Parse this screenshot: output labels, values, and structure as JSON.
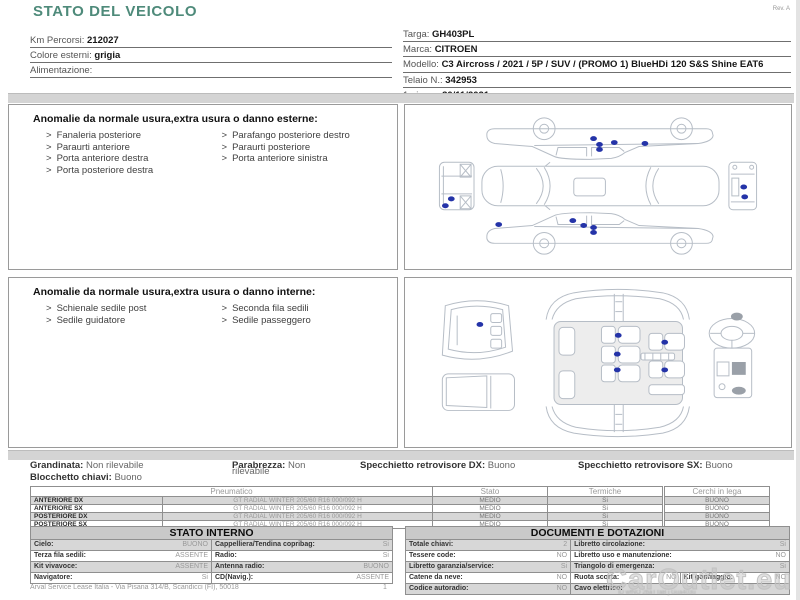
{
  "page": {
    "title": "STATO DEL VEICOLO",
    "rev": "Rev. A",
    "footer": {
      "company": "Arval Service Lease Italia - Via Pisana 314/B, Scandicci (FI), 50018",
      "page_number": "1",
      "watermark": "CarOutlet.eu",
      "id_text": "ID wfNO 2baTTaB j Gua403u"
    }
  },
  "vehicle": {
    "left_fields": [
      {
        "label": "Km Percorsi:",
        "value": "212027"
      },
      {
        "label": "Colore esterni:",
        "value": "grigia"
      },
      {
        "label": "Alimentazione:",
        "value": ""
      }
    ],
    "right_fields": [
      {
        "label": "Targa:",
        "value": "GH403PL"
      },
      {
        "label": "Marca:",
        "value": "CITROEN"
      },
      {
        "label": "Modello:",
        "value": "C3 Aircross / 2021 / 5P / SUV / (PROMO 1) BlueHDi 120 S&S Shine EAT6"
      },
      {
        "label": "Telaio N.:",
        "value": "342953"
      },
      {
        "label": "1a imm.:",
        "value": "30/11/2021"
      }
    ]
  },
  "external_anomalies": {
    "title": "Anomalie da normale usura,extra usura o danno esterne:",
    "bullet": ">",
    "col1": [
      "Fanaleria posteriore",
      "Paraurti anteriore",
      "Porta anteriore destra",
      "Porta posteriore destra"
    ],
    "col2": [
      "Parafango posteriore destro",
      "Paraurti posteriore",
      "Porta anteriore sinistra"
    ]
  },
  "internal_anomalies": {
    "title": "Anomalie da normale usura,extra usura o danno interne:",
    "bullet": ">",
    "col1": [
      "Schienale sedile post",
      "Sedile guidatore"
    ],
    "col2": [
      "Seconda fila sedili",
      "Sedile passeggero"
    ]
  },
  "conditions": {
    "grandinata": {
      "label": "Grandinata:",
      "value": "Non rilevabile"
    },
    "parabrezza": {
      "label": "Parabrezza:",
      "value": "Non",
      "value_overflow": "rilevabile"
    },
    "specchietto_dx": {
      "label": "Specchietto retrovisore DX:",
      "value": "Buono"
    },
    "specchietto_sx": {
      "label": "Specchietto retrovisore SX:",
      "value": "Buono"
    },
    "blocchetto": {
      "label": "Blocchetto chiavi:",
      "value": "Buono"
    }
  },
  "tyres": {
    "header": "Pneumatico",
    "col_stato": "Stato",
    "col_termiche": "Termiche",
    "col_cerchi": "Cerchi in lega",
    "rows": [
      {
        "pos": "ANTERIORE DX",
        "spec": "GT RADIAL WINTER 205/60 R16 000/092 H",
        "stato": "MEDIO",
        "termiche": "Si",
        "cerchi": "BUONO"
      },
      {
        "pos": "ANTERIORE SX",
        "spec": "GT RADIAL WINTER 205/60 R16 000/092 H",
        "stato": "MEDIO",
        "termiche": "Si",
        "cerchi": "BUONO"
      },
      {
        "pos": "POSTERIORE DX",
        "spec": "GT RADIAL WINTER 205/60 R16 000/092 H",
        "stato": "MEDIO",
        "termiche": "Si",
        "cerchi": "BUONO"
      },
      {
        "pos": "POSTERIORE SX",
        "spec": "GT RADIAL WINTER 205/60 R16 000/092 H",
        "stato": "MEDIO",
        "termiche": "Si",
        "cerchi": "BUONO"
      }
    ]
  },
  "stato_interno": {
    "title": "STATO INTERNO",
    "rows": [
      {
        "l_label": "Cielo:",
        "l_value": "BUONO",
        "r_label": "Cappelliera/Tendina copribag:",
        "r_value": "Si"
      },
      {
        "l_label": "Terza fila sedili:",
        "l_value": "ASSENTE",
        "r_label": "Radio:",
        "r_value": "Si"
      },
      {
        "l_label": "Kit vivavoce:",
        "l_value": "ASSENTE",
        "r_label": "Antenna radio:",
        "r_value": "BUONO"
      },
      {
        "l_label": "Navigatore:",
        "l_value": "Si",
        "r_label": "CD(Navig.):",
        "r_value": "ASSENTE"
      }
    ]
  },
  "documenti": {
    "title": "DOCUMENTI E DOTAZIONI",
    "rows_left": [
      {
        "label": "Totale chiavi:",
        "value": "2"
      },
      {
        "label": "Tessere code:",
        "value": "NO"
      },
      {
        "label": "Libretto garanzia/service:",
        "value": "Si"
      },
      {
        "label": "Catene da neve:",
        "value": "NO"
      },
      {
        "label": "Codice autoradio:",
        "value": "NO"
      }
    ],
    "rows_right": [
      {
        "label": "Libretto circolazione:",
        "value": "Si"
      },
      {
        "label": "Libretto uso e manutenzione:",
        "value": "NO"
      },
      {
        "label": "Triangolo di emergenza:",
        "value": "Si"
      },
      {
        "label": "Ruota scorta:",
        "value": "NO",
        "label2": "Kit gonfiaggio:",
        "value2": "NO"
      },
      {
        "label": "Cavo elettrico:",
        "value": ""
      }
    ]
  },
  "diagram_dots": {
    "color": "#2433a8",
    "exterior": [
      [
        190,
        34
      ],
      [
        196,
        40
      ],
      [
        211,
        38
      ],
      [
        242,
        39
      ],
      [
        196,
        45
      ],
      [
        46,
        95
      ],
      [
        40,
        102
      ],
      [
        342,
        83
      ],
      [
        343,
        93
      ],
      [
        94,
        121
      ],
      [
        169,
        117
      ],
      [
        180,
        122
      ],
      [
        190,
        124
      ],
      [
        190,
        129
      ]
    ],
    "interior": [
      [
        75,
        47
      ],
      [
        215,
        58
      ],
      [
        262,
        65
      ],
      [
        214,
        77
      ],
      [
        214,
        93
      ],
      [
        262,
        93
      ]
    ]
  }
}
